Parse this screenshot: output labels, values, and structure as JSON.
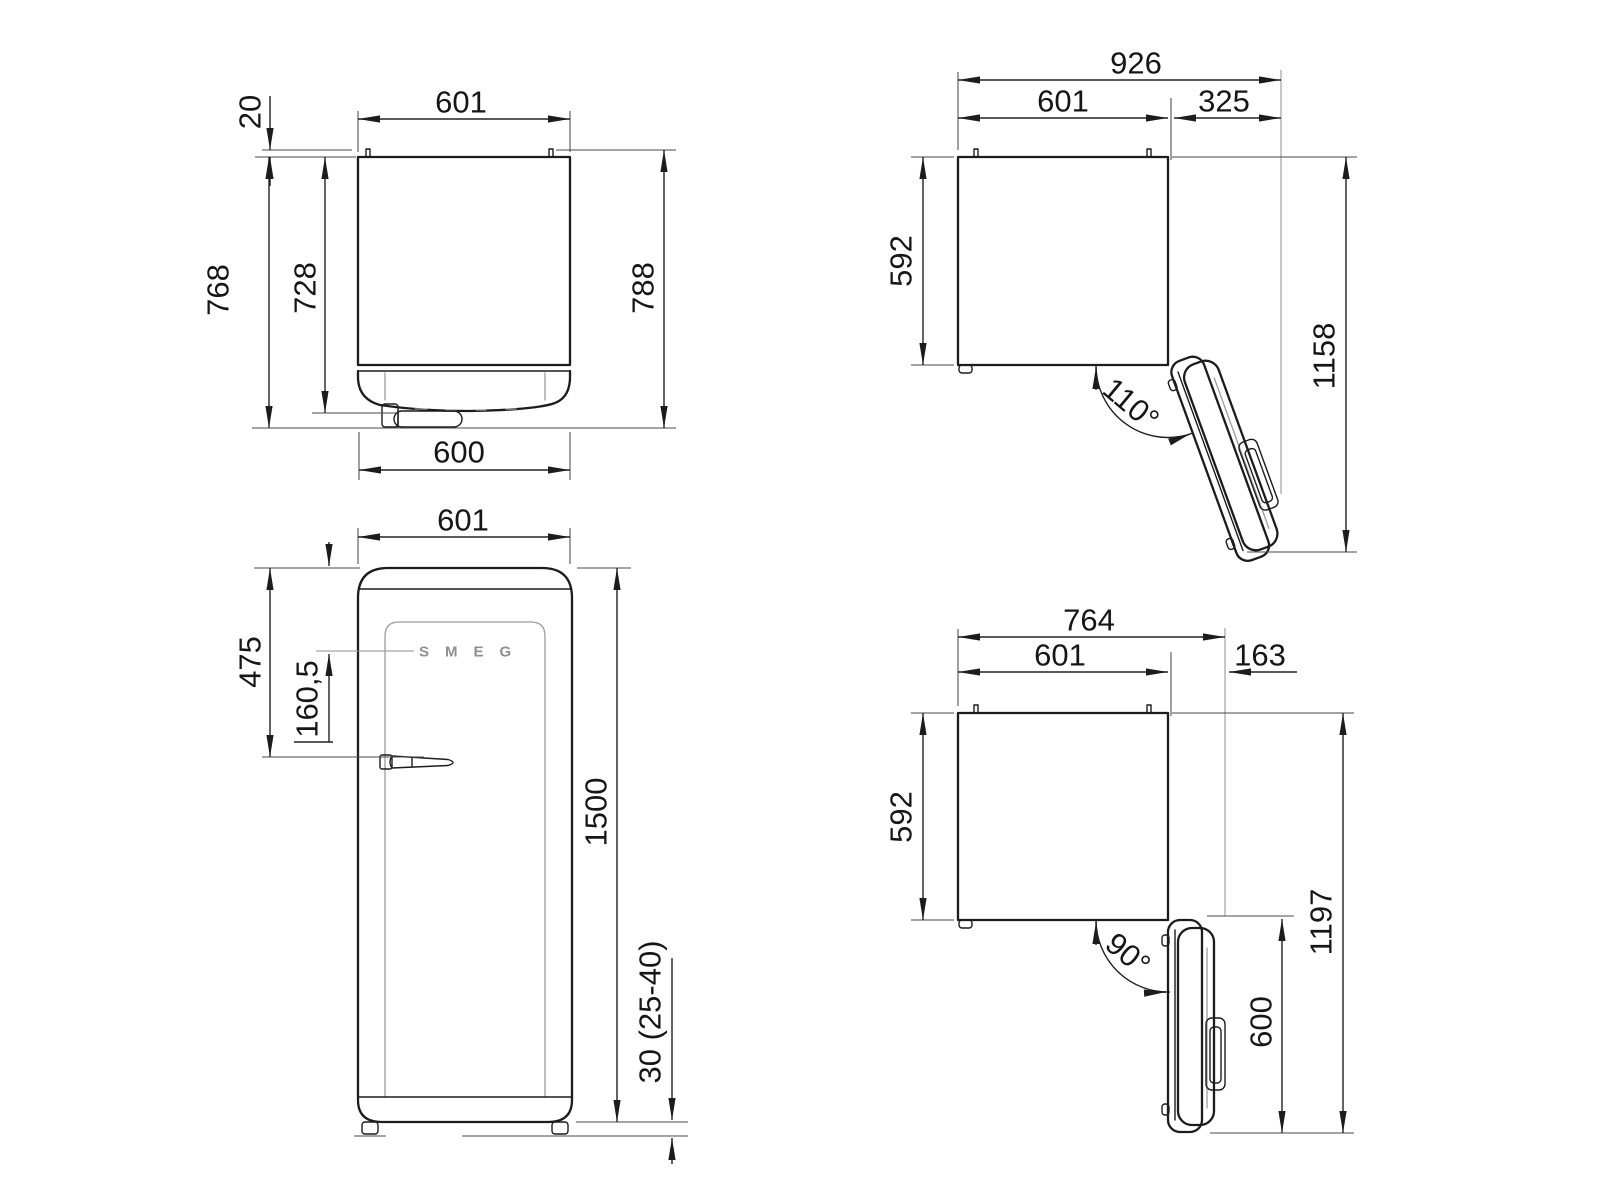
{
  "drawing": {
    "product": "refrigerator dimension drawing",
    "views": {
      "top_closed": {
        "name": "top view - door closed",
        "dims": {
          "rear_spacer": "20",
          "width": "601",
          "depth_with_door": "768",
          "body_depth": "728",
          "total_depth": "788",
          "door_width": "600"
        }
      },
      "door_110": {
        "name": "top view - door open 110 degrees",
        "dims": {
          "overall_width": "926",
          "width": "601",
          "door_clearance": "325",
          "body_depth": "592",
          "door_angle": "110°",
          "open_depth": "1158"
        }
      },
      "front": {
        "name": "front view",
        "brand": "SMEG",
        "dims": {
          "width": "601",
          "handle_from_top": "475",
          "logo_from_top": "160,5",
          "height": "1500",
          "feet_height": "30 (25-40)"
        }
      },
      "door_90": {
        "name": "top view - door open 90 degrees",
        "dims": {
          "overall_width": "764",
          "width": "601",
          "door_clearance": "163",
          "body_depth": "592",
          "door_angle": "90°",
          "open_depth": "1197",
          "door_width": "600"
        }
      }
    }
  }
}
